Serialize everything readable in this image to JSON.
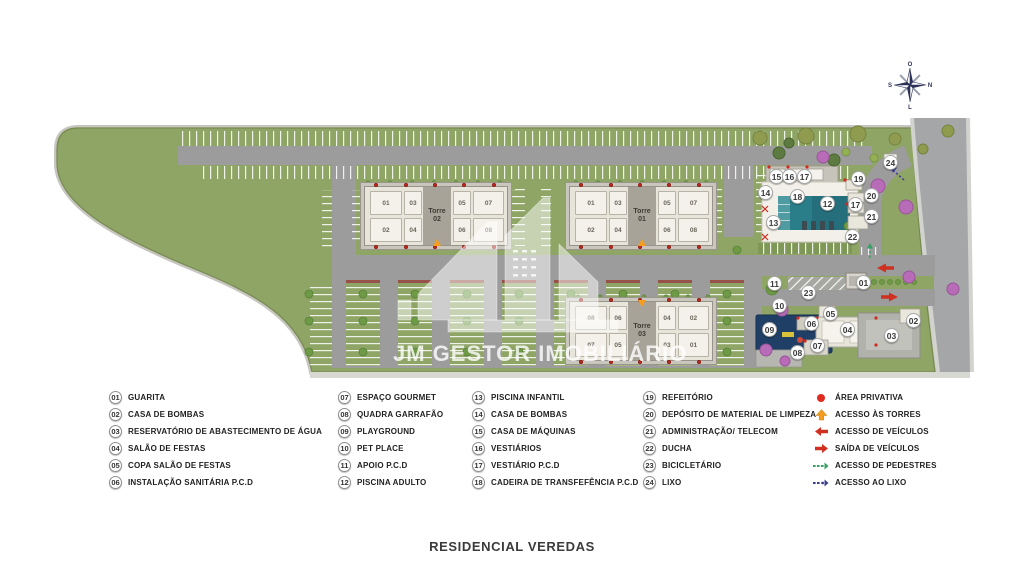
{
  "page": {
    "title": "RESIDENCIAL VEREDAS",
    "watermark": "JM GESTOR IMOBILIÁRIO"
  },
  "compass": {
    "top": "O",
    "right": "N",
    "bottom": "L",
    "left": "S"
  },
  "towers": {
    "t02": {
      "line1": "Torre",
      "line2": "02",
      "units_top": [
        "01",
        "03",
        "05",
        "07"
      ],
      "units_bottom": [
        "02",
        "04",
        "06",
        "08"
      ]
    },
    "t01": {
      "line1": "Torre",
      "line2": "01",
      "units_top": [
        "01",
        "03",
        "05",
        "07"
      ],
      "units_bottom": [
        "02",
        "04",
        "06",
        "08"
      ]
    },
    "t03": {
      "line1": "Torre",
      "line2": "03",
      "units_top": [
        "08",
        "06",
        "04",
        "02"
      ],
      "units_bottom": [
        "07",
        "05",
        "03",
        "01"
      ]
    }
  },
  "callouts": {
    "c01": "01",
    "c02": "02",
    "c03": "03",
    "c04": "04",
    "c05": "05",
    "c06": "06",
    "c07": "07",
    "c08": "08",
    "c09": "09",
    "c10": "10",
    "c11": "11",
    "c12": "12",
    "c13": "13",
    "c14": "14",
    "c15": "15",
    "c16": "16",
    "c17": "17",
    "c17b": "17",
    "c18": "18",
    "c19": "19",
    "c20": "20",
    "c21": "21",
    "c22": "22",
    "c23": "23",
    "c24": "24"
  },
  "legend": {
    "col1": [
      {
        "num": "01",
        "label": "GUARITA"
      },
      {
        "num": "02",
        "label": "CASA DE BOMBAS"
      },
      {
        "num": "03",
        "label": "RESERVATÓRIO DE ABASTECIMENTO DE ÁGUA"
      },
      {
        "num": "04",
        "label": "SALÃO DE FESTAS"
      },
      {
        "num": "05",
        "label": "COPA SALÃO DE FESTAS"
      },
      {
        "num": "06",
        "label": "INSTALAÇÃO SANITÁRIA P.C.D"
      }
    ],
    "col2": [
      {
        "num": "07",
        "label": "ESPAÇO GOURMET"
      },
      {
        "num": "08",
        "label": "QUADRA GARRAFÃO"
      },
      {
        "num": "09",
        "label": "PLAYGROUND"
      },
      {
        "num": "10",
        "label": "PET PLACE"
      },
      {
        "num": "11",
        "label": "APOIO P.C.D"
      },
      {
        "num": "12",
        "label": "PISCINA ADULTO"
      }
    ],
    "col3": [
      {
        "num": "13",
        "label": "PISCINA INFANTIL"
      },
      {
        "num": "14",
        "label": "CASA DE BOMBAS"
      },
      {
        "num": "15",
        "label": "CASA DE MÁQUINAS"
      },
      {
        "num": "16",
        "label": "VESTIÁRIOS"
      },
      {
        "num": "17",
        "label": "VESTIÁRIO P.C.D"
      },
      {
        "num": "18",
        "label": "CADEIRA DE TRANSFEFÊNCIA P.C.D"
      }
    ],
    "col4": [
      {
        "num": "19",
        "label": "REFEITÓRIO"
      },
      {
        "num": "20",
        "label": "DEPÓSITO DE MATERIAL DE LIMPEZA"
      },
      {
        "num": "21",
        "label": "ADMINISTRAÇÃO/ TELECOM"
      },
      {
        "num": "22",
        "label": "DUCHA"
      },
      {
        "num": "23",
        "label": "BICICLETÁRIO"
      },
      {
        "num": "24",
        "label": "LIXO"
      }
    ],
    "symbols": [
      {
        "icon": "area-dot",
        "label": "ÁREA PRIVATIVA"
      },
      {
        "icon": "arrow-up",
        "label": "ACESSO ÀS TORRES"
      },
      {
        "icon": "arrow-left",
        "label": "ACESSO DE VEÍCULOS"
      },
      {
        "icon": "arrow-right",
        "label": "SAÍDA DE VEÍCULOS"
      },
      {
        "icon": "dashed-arrow-green",
        "label": "ACESSO DE PEDESTRES"
      },
      {
        "icon": "dashed-arrow-navy",
        "label": "ACESSO AO LIXO"
      }
    ]
  },
  "colors": {
    "site_green": "#8ea566",
    "road": "#9c9c9c",
    "pool": "#2a7e89",
    "accent_red": "#d0301f",
    "accent_orange": "#f59d1e",
    "pedestrian_green": "#36a062",
    "trash_navy": "#3b3e8f"
  }
}
